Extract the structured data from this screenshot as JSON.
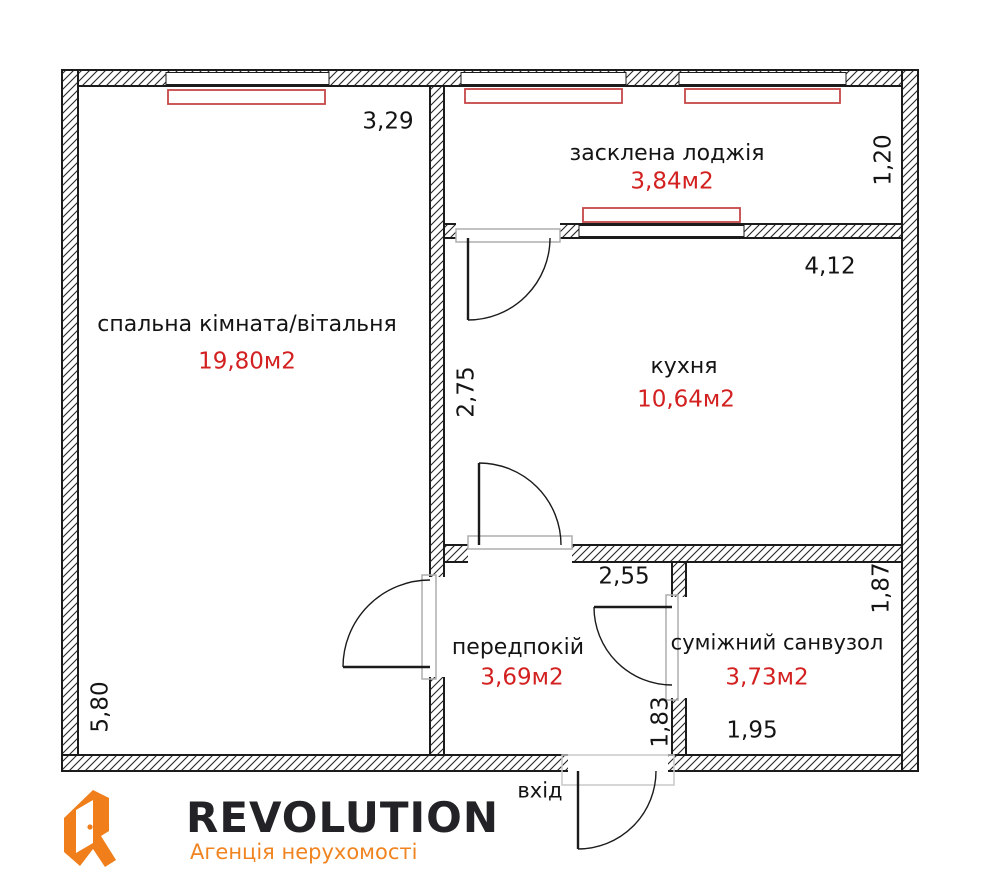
{
  "rooms": {
    "bedroom": {
      "name": "спальна кімната/вітальня",
      "area": "19,80м2",
      "width_m": "3,29",
      "height_m": "5,80"
    },
    "loggia": {
      "name": "засклена лоджія",
      "area": "3,84м2",
      "depth_m": "1,20"
    },
    "kitchen": {
      "name": "кухня",
      "area": "10,64м2",
      "width_m": "4,12",
      "height_m": "2,75"
    },
    "hallway": {
      "name": "передпокій",
      "area": "3,69м2",
      "width_m": "2,55",
      "door_m": "1,83"
    },
    "bathroom": {
      "name": "суміжний санвузол",
      "area": "3,73м2",
      "depth_m": "1,87",
      "width_m": "1,95"
    }
  },
  "entrance": {
    "label": "вхід"
  },
  "branding": {
    "logo_text": "REVOLUTION",
    "tagline": "Агенція нерухомості"
  },
  "colors": {
    "accent_red": "#d32020",
    "window_red": "#c64747",
    "wall_black": "#1b1b1b",
    "door_frame_gray": "#aeaeae",
    "logo_orange": "#EF7E1B",
    "logo_dark": "#232327"
  }
}
